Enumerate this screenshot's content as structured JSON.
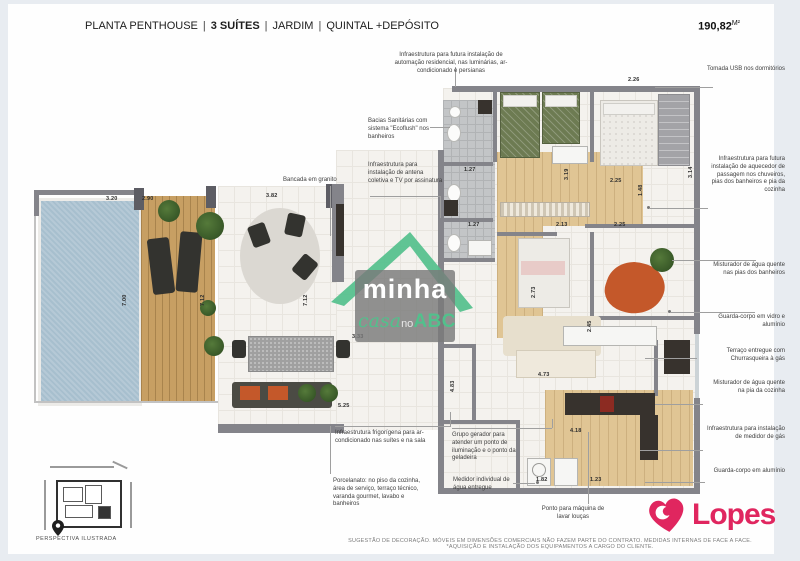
{
  "header": {
    "title": "PLANTA PENTHOUSE",
    "divider": "|",
    "suites": "3 SUÍTES",
    "feature_jardim": "JARDIM",
    "feature_quintal": "QUINTAL +DEPÓSITO",
    "area_value": "190,82",
    "area_unit": "M²"
  },
  "callouts": {
    "top_automacao": "Infraestrutura para futura instalação de automação residencial, nas luminárias, ar-condicionado e persianas",
    "left": [
      {
        "id": "ecoflush",
        "text": "Bacias Sanitárias com sistema \"Ecoflush\" nos banheiros"
      },
      {
        "id": "antena",
        "text": "Infraestrutura para instalação de antena coletiva e TV por assinatura"
      },
      {
        "id": "bancada",
        "text": "Bancada em granito"
      },
      {
        "id": "frigorigena",
        "text": "Infraestrutura frigorígena para ar-condicionado nas suítes e na sala"
      },
      {
        "id": "porcelanato",
        "text": "Porcelanato: no piso da cozinha, área de serviço, terraço técnico, varanda gourmet, lavabo e banheiros"
      },
      {
        "id": "gerador",
        "text": "Grupo gerador para atender um ponto de iluminação e o ponto da geladeira"
      },
      {
        "id": "medidor-agua",
        "text": "Medidor individual de água entregue"
      },
      {
        "id": "maquina-loucas",
        "text": "Ponto para máquina de lavar louças"
      }
    ],
    "right": [
      {
        "id": "tomada-usb",
        "text": "Tomada USB nos dormitórios"
      },
      {
        "id": "aquecedor",
        "text": "Infraestrutura para futura instalação de aquecedor de passagem nos chuveiros, pias dos banheiros e pia da cozinha"
      },
      {
        "id": "misturador-banheiros",
        "text": "Misturador de água quente nas pias dos banheiros"
      },
      {
        "id": "guarda-corpo-vidro",
        "text": "Guarda-corpo em vidro e alumínio"
      },
      {
        "id": "terraco-churrasqueira",
        "text": "Terraço entregue com Churrasqueira à gás"
      },
      {
        "id": "misturador-cozinha",
        "text": "Misturador de água quente na pia da cozinha"
      },
      {
        "id": "medidor-gas",
        "text": "Infraestrutura para instalação de medidor de gás"
      },
      {
        "id": "guarda-corpo-aluminio",
        "text": "Guarda-corpo em alumínio"
      }
    ]
  },
  "plan": {
    "dims": [
      "3.20",
      "2.90",
      "3.82",
      "7.00",
      "7.12",
      "7.12",
      "3.33",
      "5.25",
      "1.27",
      "3.19",
      "2.25",
      "2.26",
      "3.14",
      "1.27",
      "2.13",
      "2.25",
      "2.73",
      "2.45",
      "4.73",
      "4.83",
      "4.18",
      "1.82",
      "1.23",
      "1.48"
    ]
  },
  "watermark": {
    "word1": "minha",
    "word2": "casa",
    "word3": "no",
    "word4": "ABC"
  },
  "site_map": {
    "caption": "PERSPECTIVA ILUSTRADA"
  },
  "brand": {
    "name": "Lopes"
  },
  "footer": {
    "disclaimer": "SUGESTÃO DE DECORAÇÃO. MÓVEIS EM DIMENSÕES COMERCIAIS NÃO FAZEM PARTE DO CONTRATO. MEDIDAS INTERNAS DE FACE A FACE. *AQUISIÇÃO E INSTALAÇÃO DOS EQUIPAMENTOS A CARGO DO CLIENTE.",
    "colors": {
      "accent_green": "#52c08c",
      "brand_pink": "#e0265f",
      "wall_gray": "#84848a",
      "pool_blue": "#a7bfce"
    }
  }
}
